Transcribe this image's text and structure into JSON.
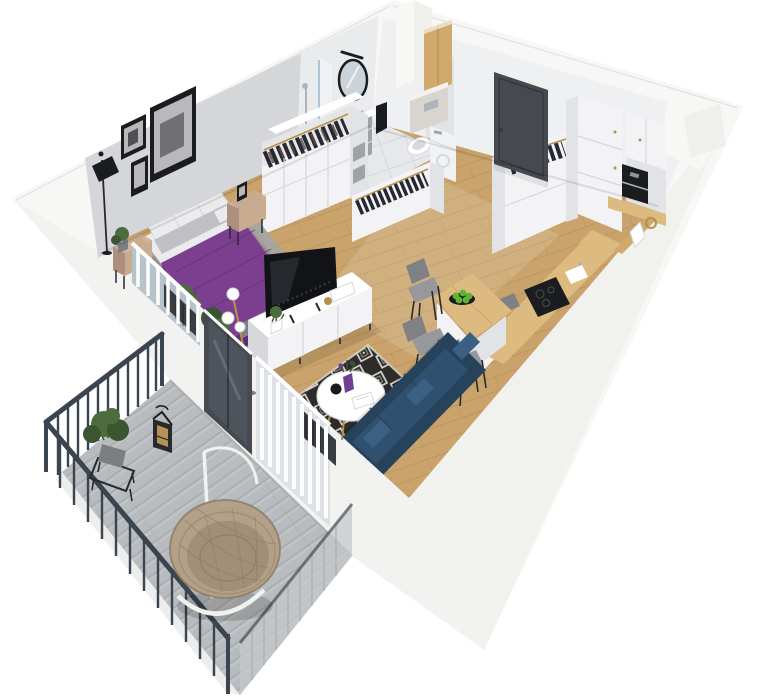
{
  "scene": {
    "description": "Isometric 3D cutaway floor-plan render of a studio apartment with a balcony",
    "rooms": [
      {
        "name": "bedroom",
        "items": [
          "double bed with purple duvet",
          "white and grey pillows",
          "grey area rug",
          "two wooden nightstands",
          "black floor lamp",
          "gallery wall art",
          "open wardrobe with hanging clothes",
          "potted plants",
          "radiator behind window"
        ]
      },
      {
        "name": "bathroom",
        "items": [
          "walk-in shower with glass panel",
          "round black framed mirror",
          "black wall sconce",
          "vanity with sink",
          "black towel",
          "toilet with concealed cistern",
          "wooden wall cabinet",
          "tall white cabinet"
        ]
      },
      {
        "name": "hallway",
        "items": [
          "charcoal entrance door",
          "open closet with coat rail"
        ]
      },
      {
        "name": "kitchen",
        "items": [
          "tall white cabinet columns",
          "built-in coffee machine",
          "oak worktop",
          "black induction hob",
          "sink",
          "breakfast bar peninsula",
          "plate of green apples",
          "three grey bar chairs",
          "oak ledge with brass ring"
        ]
      },
      {
        "name": "living-room",
        "items": [
          "navy three-seat sofa",
          "black TV on white media console",
          "small plant and books on console",
          "round white coffee table",
          "purple vase with flowers",
          "black teapot",
          "black-and-white diamond rug",
          "brass arc floor lamp with glass globes",
          "radiator behind window"
        ]
      },
      {
        "name": "balcony",
        "items": [
          "dark metal railing with balusters",
          "grey plank decking",
          "rattan hanging egg chair on white stand",
          "potted plant on black stand",
          "black lantern",
          "grey mesh side panel",
          "dark glazed balcony door"
        ]
      }
    ]
  },
  "palette": {
    "wallOuter": "#f7f7f5",
    "wallShade": "#efefec",
    "wallFace": "#d5d6da",
    "wallFaceLight": "#e2e3e7",
    "wallFaceNE": "#eff0f2",
    "tileWall": "#e9ebed",
    "floorWood": "#c9a36b",
    "floorWoodLine": "#b18a52",
    "tileFloor": "#e6e8ea",
    "tileLine": "#d2d5d9",
    "rugBedroom": "#a8a4a0",
    "rugBase": "#dcd9d2",
    "rugDark": "#2e2c2a",
    "bedPurple": "#7c3f90",
    "bedPurpleDark": "#5e2f70",
    "pillowWhite": "#ebebee",
    "pillowGray": "#bfc0c5",
    "throwGray": "#7f8187",
    "woodTan": "#c9ab92",
    "woodTanDark": "#ae8f7d",
    "furnWhite": "#f3f3f5",
    "seamGray": "#d7d8db",
    "clothesDark": "#262933",
    "clothesBrown": "#5f4a38",
    "doorDark": "#46494f",
    "doorDarker": "#33363c",
    "cabinetWood": "#d2a96c",
    "counterWood": "#ddbb80",
    "counterShade": "#c8a162",
    "white": "#ffffff",
    "applianceBlack": "#1b1c1f",
    "steel": "#aeb4b9",
    "sofaNavy": "#2f506e",
    "sofaDark": "#27435c",
    "sofaLight": "#3b6084",
    "tvBlack": "#121316",
    "chairGray": "#96989b",
    "chairDark": "#7f8184",
    "legBlack": "#2a2a2e",
    "railDark": "#3b4550",
    "balconyFloor": "#b9bcbe",
    "deckLight": "#cbcED0",
    "deckShade": "#a4a7aa",
    "meshGray": "#c5c8cb",
    "rattan": "#b2a089",
    "rattanDark": "#8c7b64",
    "standWhite": "#f1f1ef",
    "plantGreen": "#4d6c3d",
    "plantDark": "#3a5530",
    "appleGreen": "#5eb430",
    "vasePurple": "#6f4090",
    "brass": "#b4914e",
    "glassBlue": "#a7c9da",
    "glassPane": "#b6c3cb",
    "curtain": "#f4f5f6",
    "curtainShade": "#dde1e5",
    "mirrorGlass": "#ccd3d8",
    "radiatorDark": "#393c41",
    "cistern": "#d8d4ce",
    "binGray": "#9fa3a8",
    "potGray": "#7b7e83",
    "artGray": "#b9b9bc",
    "artDark": "#505056",
    "washer": "#f1f2f3"
  }
}
